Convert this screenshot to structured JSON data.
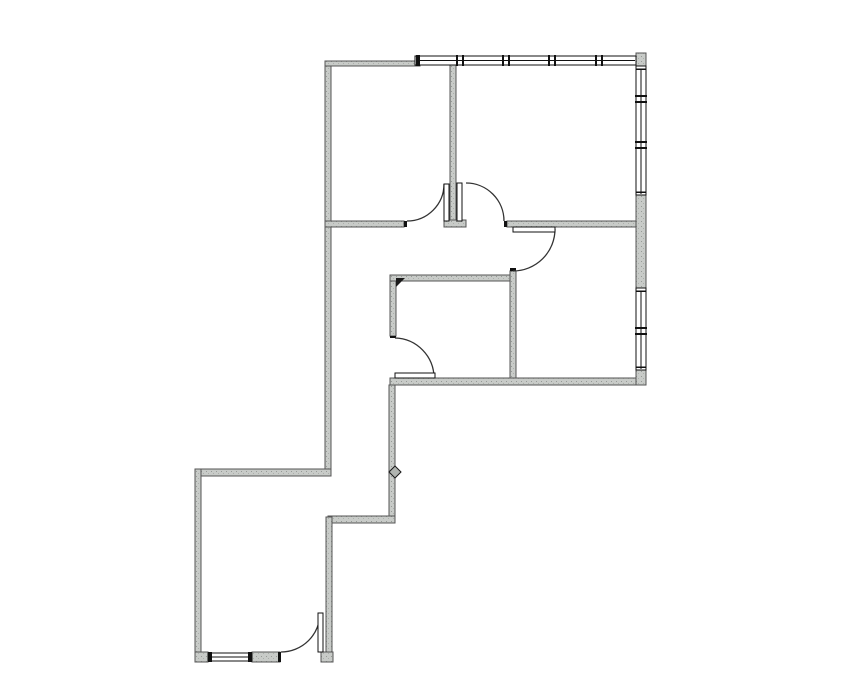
{
  "page": {
    "width": 855,
    "height": 678,
    "background": "#ffffff"
  },
  "plan": {
    "colors": {
      "wall_fill_base": "#c8cbc8",
      "wall_fill_dot1": "#969a96",
      "wall_fill_dot2": "#aaaeaa",
      "wall_edge": "#555555",
      "frame": "#111111",
      "door_arc": "#333333",
      "leaf_fill": "#ffffff",
      "window_fill": "#ffffff"
    },
    "walls": [
      {
        "name": "wall-exterior-left",
        "x": 325,
        "y": 61,
        "w": 6,
        "h": 415
      },
      {
        "name": "wall-top-gray",
        "x": 325,
        "y": 61,
        "w": 95,
        "h": 5
      },
      {
        "name": "wall-top-center-divider",
        "x": 450,
        "y": 64,
        "w": 6,
        "h": 157
      },
      {
        "name": "wall-top-center-divider-cap",
        "x": 444,
        "y": 220,
        "w": 22,
        "h": 7
      },
      {
        "name": "wall-toprooms-bottom-west",
        "x": 325,
        "y": 221,
        "w": 79,
        "h": 6
      },
      {
        "name": "wall-toprooms-bottom-east",
        "x": 507,
        "y": 221,
        "w": 129,
        "h": 6
      },
      {
        "name": "wall-hall-south",
        "x": 390,
        "y": 275,
        "w": 126,
        "h": 6
      },
      {
        "name": "wall-mid-divider",
        "x": 510,
        "y": 271,
        "w": 6,
        "h": 112
      },
      {
        "name": "wall-midleft-west",
        "x": 390,
        "y": 281,
        "w": 6,
        "h": 55
      },
      {
        "name": "wall-mid-bottom",
        "x": 390,
        "y": 378,
        "w": 246,
        "h": 7
      },
      {
        "name": "wall-corridor-east",
        "x": 389,
        "y": 385,
        "w": 6,
        "h": 138
      },
      {
        "name": "wall-corridor-end",
        "x": 328,
        "y": 516,
        "w": 67,
        "h": 7
      },
      {
        "name": "wall-bottomroom-east",
        "x": 326,
        "y": 517,
        "w": 6,
        "h": 145
      },
      {
        "name": "wall-bottomroom-north",
        "x": 195,
        "y": 469,
        "w": 136,
        "h": 7
      },
      {
        "name": "wall-bottomroom-west",
        "x": 195,
        "y": 469,
        "w": 6,
        "h": 193
      },
      {
        "name": "wall-bottomroom-south-a",
        "x": 195,
        "y": 652,
        "w": 13,
        "h": 10
      },
      {
        "name": "wall-bottomroom-south-b",
        "x": 252,
        "y": 652,
        "w": 28,
        "h": 10
      },
      {
        "name": "wall-bottomroom-south-stub",
        "x": 321,
        "y": 652,
        "w": 12,
        "h": 10
      },
      {
        "name": "wall-topright-corner",
        "x": 636,
        "y": 53,
        "w": 10,
        "h": 13
      },
      {
        "name": "wall-right-mid",
        "x": 636,
        "y": 195,
        "w": 10,
        "h": 93
      },
      {
        "name": "wall-right-bottom-corner",
        "x": 636,
        "y": 370,
        "w": 10,
        "h": 15
      }
    ],
    "caps": [
      {
        "name": "jamb-doubledoor-west",
        "x": 404,
        "y": 221,
        "w": 3,
        "h": 6
      },
      {
        "name": "jamb-doubledoor-east",
        "x": 504,
        "y": 221,
        "w": 3,
        "h": 6
      },
      {
        "name": "cap-mid-divider-top",
        "x": 510,
        "y": 268,
        "w": 6,
        "h": 3
      },
      {
        "name": "cap-midleft-west-end",
        "x": 390,
        "y": 336,
        "w": 6,
        "h": 2
      },
      {
        "name": "jamb-exterior-door-west",
        "x": 278,
        "y": 652,
        "w": 3,
        "h": 10
      }
    ],
    "windows": [
      {
        "name": "window-band-top",
        "x": 415,
        "y": 56,
        "w": 221,
        "h": 9,
        "orient": "h",
        "caps": [
          418
        ],
        "dividers": [
          460,
          506,
          552,
          599
        ],
        "ticks": []
      },
      {
        "name": "window-band-right-upper",
        "x": 636,
        "y": 66,
        "w": 10,
        "h": 129,
        "orient": "v",
        "caps": [],
        "dividers": [
          99,
          145
        ],
        "ticks": [
          69,
          192
        ]
      },
      {
        "name": "window-band-right-lower",
        "x": 636,
        "y": 288,
        "w": 10,
        "h": 82,
        "orient": "v",
        "caps": [],
        "dividers": [
          331
        ],
        "ticks": [
          291,
          367
        ]
      },
      {
        "name": "window-bottomroom-south",
        "x": 208,
        "y": 653,
        "w": 44,
        "h": 8,
        "orient": "h",
        "caps": [
          210,
          250
        ],
        "dividers": [],
        "ticks": []
      }
    ],
    "doors": [
      {
        "name": "door-top-left",
        "leaf": {
          "x": 444,
          "y": 184,
          "w": 5,
          "h": 37
        },
        "arc": "M 407 221 A 37 37 0 0 0 444 184"
      },
      {
        "name": "door-top-right",
        "leaf": {
          "x": 457,
          "y": 183,
          "w": 5,
          "h": 38
        },
        "arc": "M 466 183 A 38 38 0 0 1 504 221"
      },
      {
        "name": "door-mid-right",
        "leaf": {
          "x": 513,
          "y": 227,
          "w": 42,
          "h": 5
        },
        "arc": "M 555 229 A 42 42 0 0 1 513 271"
      },
      {
        "name": "door-mid-left",
        "leaf": {
          "x": 395,
          "y": 373,
          "w": 40,
          "h": 5
        },
        "arc": "M 395 338 A 40 40 0 0 1 434 378"
      },
      {
        "name": "door-bottomroom-exterior",
        "leaf": {
          "x": 318,
          "y": 613,
          "w": 5,
          "h": 39
        },
        "arc": "M 281 652 A 39 39 0 0 0 320 613"
      }
    ],
    "markers": [
      {
        "name": "marker-corner-triangle",
        "points": "396,278 405,278 396,287",
        "fill": "#1a1a1a",
        "stroke": "none"
      },
      {
        "name": "marker-corridor-diamond",
        "points": "389,472 395,466 401,472 395,478",
        "fill": "#b0b4b0",
        "stroke": "#1a1a1a"
      }
    ]
  }
}
